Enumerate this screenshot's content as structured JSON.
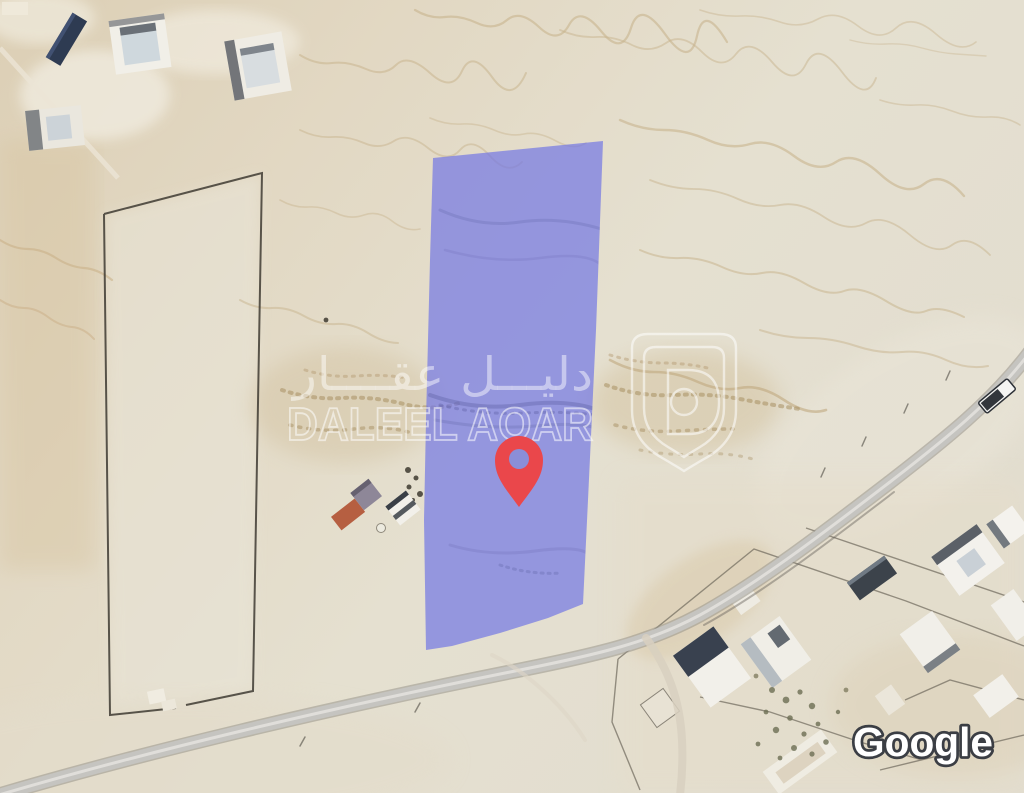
{
  "map": {
    "view": "satellite",
    "attribution": {
      "provider_label": "Google",
      "text_color": "#ffffff",
      "outline_color": "#3b3e44"
    },
    "watermark": {
      "arabic": "دليـــل عقــــار",
      "latin": "DALEEL AQAR",
      "logo": "daleel-aqar-shield",
      "color": "#ffffff"
    },
    "parcel_overlay": {
      "fill_color": "#7276e4",
      "fill_opacity": "0.70"
    },
    "marker": {
      "icon": "location-pin-icon",
      "color": "#ea474b",
      "hole_color": "#8b8ed8"
    }
  }
}
